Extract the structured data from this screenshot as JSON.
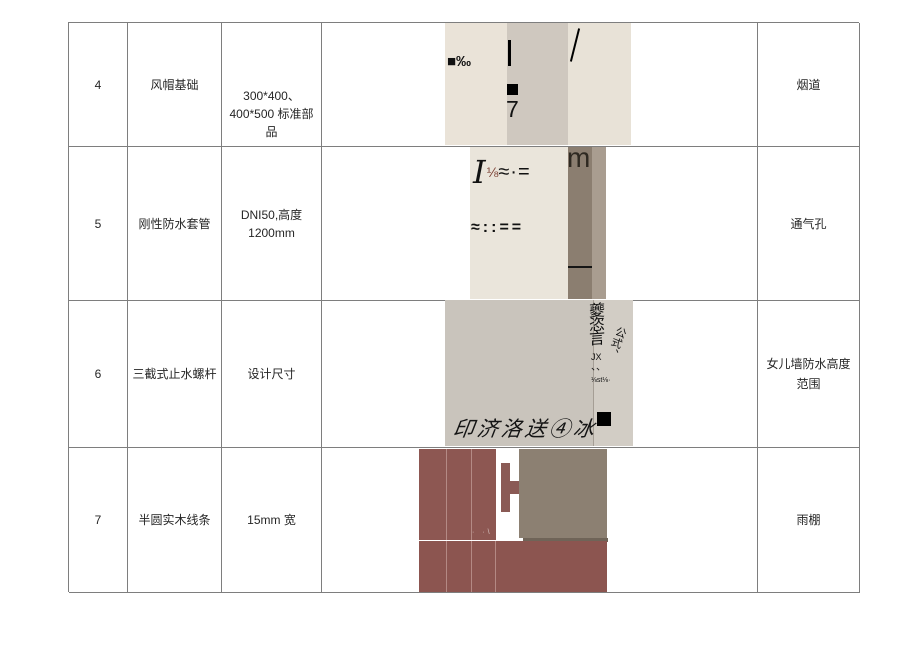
{
  "table": {
    "rows": [
      {
        "num": "4",
        "name": "风帽基础",
        "spec1": "300*400、",
        "spec2": "400*500 标准部品",
        "remark": "烟道"
      },
      {
        "num": "5",
        "name": "刚性防水套管",
        "spec1": "DNI50,高度",
        "spec2": "1200mm",
        "remark": "通气孔"
      },
      {
        "num": "6",
        "name": "三截式止水螺杆",
        "spec1": "设计尺寸",
        "spec2": "",
        "remark": "女儿墙防水高度范围"
      },
      {
        "num": "7",
        "name": "半圆实木线条",
        "spec1": "15mm 宽",
        "spec2": "",
        "remark": "雨棚"
      }
    ]
  },
  "photos": {
    "chimney": {
      "permille": "■‰",
      "digit": "7",
      "slash": "\\"
    },
    "vent": {
      "line1_I": "I",
      "line1_frac": "⅛",
      "line1_rest": "≈·=",
      "line2": "≈::==",
      "m": "m"
    },
    "parapet": {
      "calligraphy": "印济洛送④冰",
      "vertical_text": "夔恣言",
      "slant_text": "公式、",
      "jx": "JX",
      "dun_marks": "、、",
      "tiny_text": "⅛st⅛·"
    },
    "canopy": {
      "specks": "· ·\\"
    }
  },
  "colors": {
    "border": "#7e7e7e",
    "chimney_beige": "#eae3d8",
    "chimney_mid": "#cfc8bf",
    "vent_beige": "#eae5db",
    "vent_taupe": "#8b7e70",
    "vent_light_taupe": "#a99d90",
    "vent_fraction_red": "#7b4033",
    "parapet_gray": "#c9c4bc",
    "parapet_light": "#d2cdc5",
    "canopy_maroon": "#8d5752",
    "canopy_maroon_bottom": "#8c5550",
    "canopy_taupe": "#8c8072",
    "canopy_dark_strip": "#6f6458"
  }
}
